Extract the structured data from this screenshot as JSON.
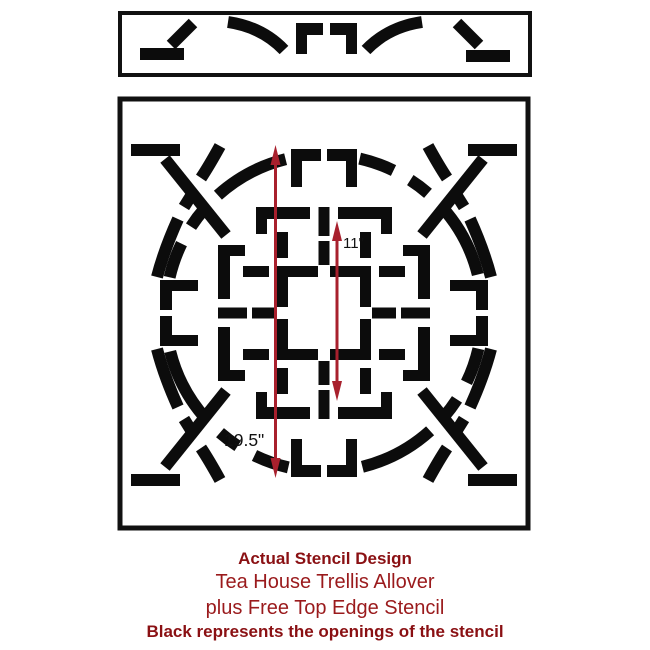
{
  "colors": {
    "background": "#ffffff",
    "stencil_black": "#0c0c0c",
    "frame_black": "#111111",
    "arrow_red": "#a8202d",
    "caption_bold_red": "#8a1013",
    "caption_regular_red": "#9a1a1c"
  },
  "measurements": {
    "inner_height": "11\"",
    "outer_height": "19.5\""
  },
  "caption": {
    "line1": "Actual Stencil Design",
    "line2": "Tea House Trellis Allover",
    "line3": "plus Free Top Edge Stencil",
    "line4": "Black represents the openings of the stencil"
  }
}
